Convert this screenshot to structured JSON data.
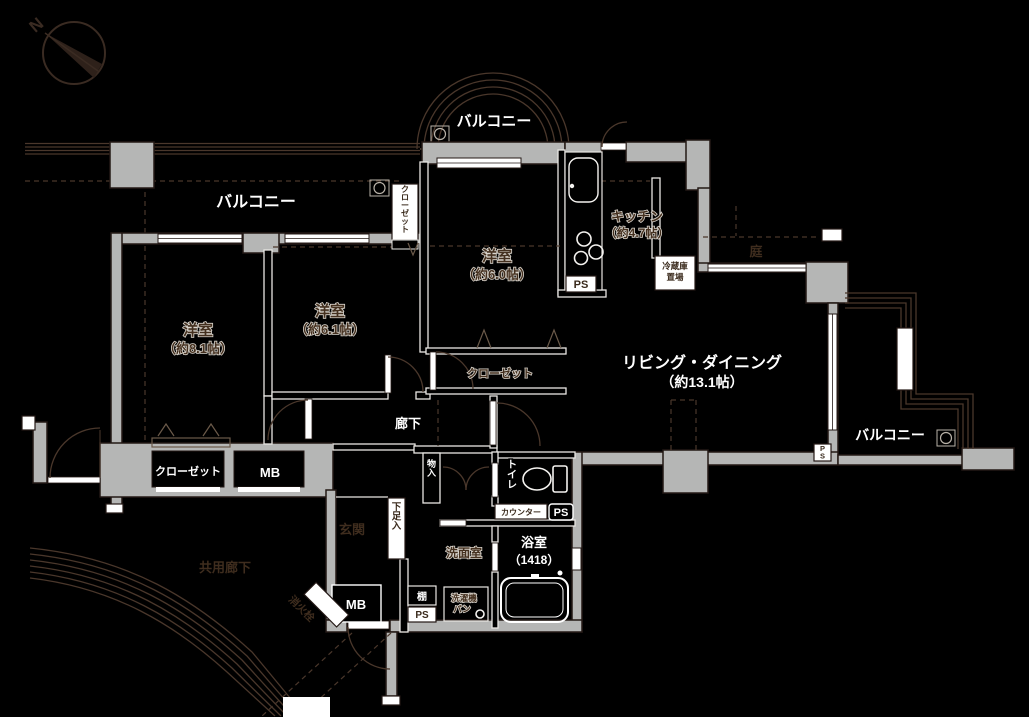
{
  "colors": {
    "background": "#000000",
    "wall_fill": "#b5b6b5",
    "wall_outline": "#231815",
    "line_dark": "#4a372b",
    "line_white": "#f2efe9",
    "text_white": "#ffffff",
    "text_dark": "#44301f"
  },
  "compass": {
    "north": "N"
  },
  "balconies": {
    "west": "バルコニー",
    "north": "バルコニー",
    "east": "バルコニー"
  },
  "rooms": {
    "bedroom_west": {
      "name": "洋室",
      "size": "（約8.1帖）"
    },
    "bedroom_center": {
      "name": "洋室",
      "size": "（約6.1帖）"
    },
    "bedroom_north": {
      "name": "洋室",
      "size": "（約6.0帖）"
    },
    "kitchen": {
      "name": "キッチン",
      "size": "（約4.7帖）"
    },
    "living_dining": {
      "name": "リビング・ダイニング",
      "size": "（約13.1帖）"
    },
    "bathroom": {
      "name": "浴室",
      "size": "（1418）"
    },
    "washroom": {
      "name": "洗面室"
    },
    "toilet": {
      "name": "トイレ"
    },
    "entrance": {
      "name": "玄関"
    },
    "corridor": {
      "name": "廊下"
    }
  },
  "storage": {
    "closet_west": "クローゼット",
    "closet_center": "クローゼット",
    "closet_north": "クローゼット",
    "hall_storage": "物入",
    "shoe_cabinet": "下足入",
    "shelf": "棚"
  },
  "equipment": {
    "mb_west": "MB",
    "mb_south": "MB",
    "ps_kitchen": "PS",
    "ps_toilet": "PS",
    "ps_washroom": "PS",
    "ps_balcony": "PS",
    "counter": "カウンター",
    "laundry_pan": [
      "洗濯機",
      "パン"
    ],
    "fridge_space": [
      "冷蔵庫",
      "置場"
    ],
    "fire_hydrant": "消火栓"
  },
  "exterior": {
    "garden": "庭",
    "common_corridor": "共用廊下"
  }
}
